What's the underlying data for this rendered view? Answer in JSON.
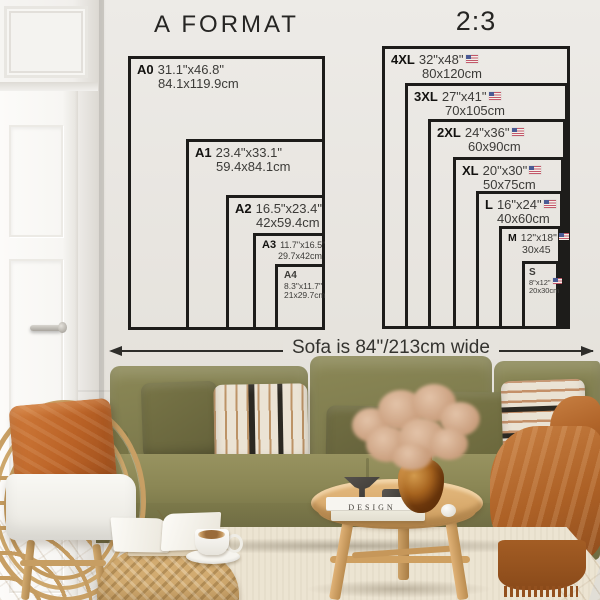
{
  "a_format": {
    "title": "A FORMAT",
    "sizes": [
      {
        "code": "A0",
        "inches": "31.1\"x46.8\"",
        "cm": "84.1x119.9cm"
      },
      {
        "code": "A1",
        "inches": "23.4\"x33.1\"",
        "cm": "59.4x84.1cm"
      },
      {
        "code": "A2",
        "inches": "16.5\"x23.4\"",
        "cm": "42x59.4cm"
      },
      {
        "code": "A3",
        "inches": "11.7\"x16.5\"",
        "cm": "29.7x42cm"
      },
      {
        "code": "A4",
        "inches": "8.3\"x11.7\"",
        "cm": "21x29.7cm"
      }
    ]
  },
  "ratio": {
    "title": "2:3",
    "flag": "us-flag",
    "sizes": [
      {
        "code": "4XL",
        "inches": "32\"x48\"",
        "cm": "80x120cm"
      },
      {
        "code": "3XL",
        "inches": "27\"x41\"",
        "cm": "70x105cm"
      },
      {
        "code": "2XL",
        "inches": "24\"x36\"",
        "cm": "60x90cm"
      },
      {
        "code": "XL",
        "inches": "20\"x30\"",
        "cm": "50x75cm"
      },
      {
        "code": "L",
        "inches": "16\"x24\"",
        "cm": "40x60cm"
      },
      {
        "code": "M",
        "inches": "12\"x18\"",
        "cm": "30x45"
      },
      {
        "code": "S",
        "inches": "8\"x12\"",
        "cm": "20x30cm"
      }
    ]
  },
  "sofa": {
    "width_label": "Sofa is 84\"/213cm wide"
  },
  "decor": {
    "book_spine": "DESIGN"
  },
  "colors": {
    "wall": "#e7e4de",
    "diagram_line": "#1d1c1a",
    "sofa_olive": "#827f4f",
    "pillow_olive": "#6d6a3e",
    "rust_orange": "#bb6a31",
    "wood": "#d9ab6e",
    "rattan": "#c79e63",
    "rug": "#ece4d3"
  }
}
